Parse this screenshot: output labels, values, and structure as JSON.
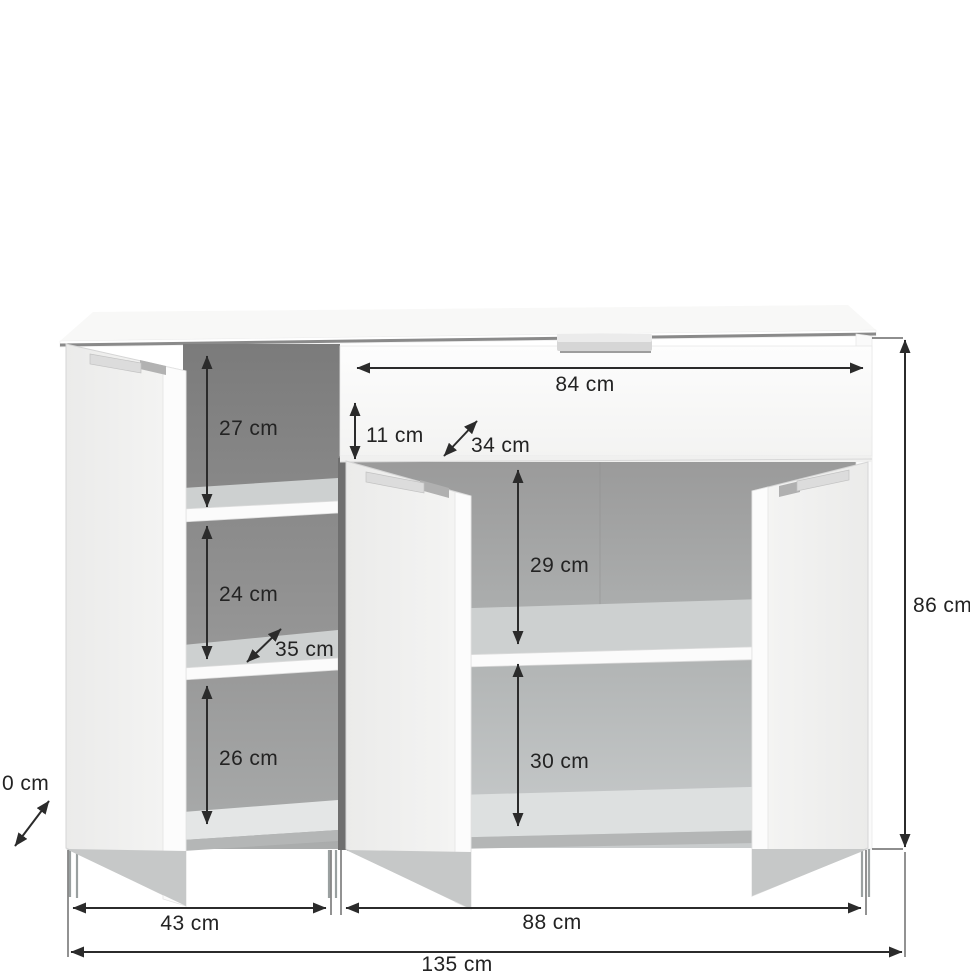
{
  "diagram": {
    "kind": "furniture-dimension-diagram",
    "subject": "sideboard with three open doors, one drawer, shelves and dimension arrows"
  },
  "dimensions": {
    "drawer_width": "84 cm",
    "drawer_front_height": "11 cm",
    "drawer_depth": "34 cm",
    "left_top_compartment_height": "27 cm",
    "left_middle_compartment_height": "24 cm",
    "left_shelf_depth": "35 cm",
    "left_bottom_compartment_height": "26 cm",
    "right_upper_compartment_height": "29 cm",
    "right_lower_compartment_height": "30 cm",
    "overall_height": "86 cm",
    "left_section_width": "43 cm",
    "right_section_width": "88 cm",
    "overall_width": "135 cm",
    "depth_label_cutoff": "0 cm"
  },
  "colors": {
    "background": "#ffffff",
    "dimension_line": "#2b2b2b",
    "interior_dark": "#7d7d7d",
    "interior_light": "#c8cbcc",
    "panel_white": "#fafafa",
    "door_face": "#ececeb",
    "handle_gray": "#d9d9d9",
    "top_edge_shadow": "#8a8a8a"
  }
}
